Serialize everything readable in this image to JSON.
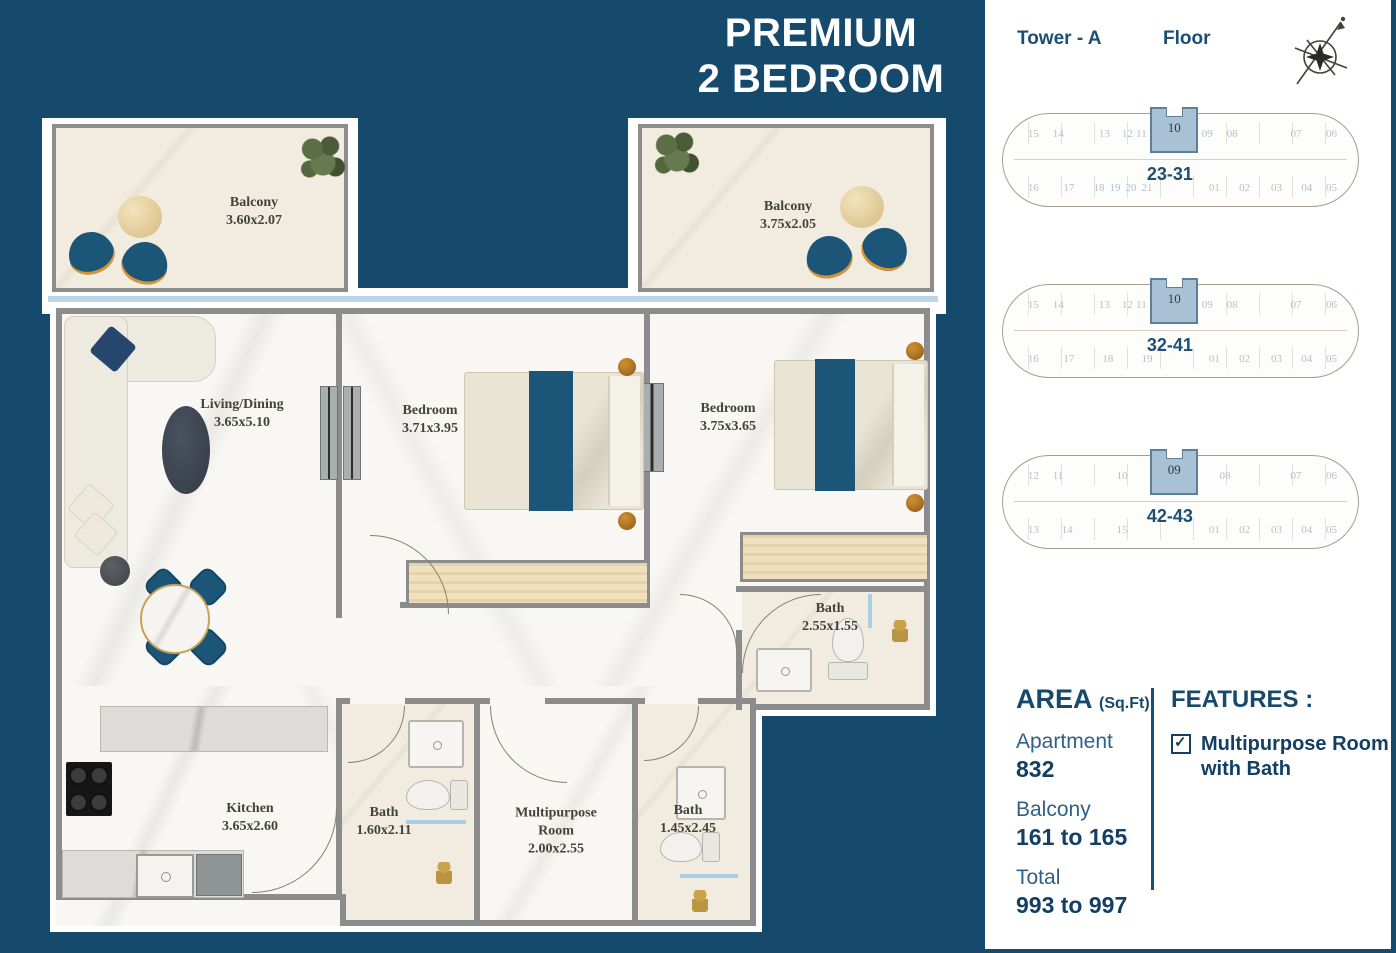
{
  "colors": {
    "brand_blue": "#164a6d",
    "accent_text": "#1d4e74",
    "highlight_unit_fill": "#a9c1d4",
    "furniture_teal": "#1b5578",
    "window_glass": "#b9d7ea",
    "wall_gray": "#8c8c8c"
  },
  "title": {
    "line1": "PREMIUM",
    "line2": "2 BEDROOM"
  },
  "header": {
    "tower": "Tower - A",
    "floor": "Floor",
    "compass_icon": "compass-rose-icon"
  },
  "plates": [
    {
      "range": "23-31",
      "unit": "10",
      "top": [
        "15",
        "14",
        "13",
        "12",
        "11",
        "09",
        "08",
        "07",
        "06"
      ],
      "bottom": [
        "16",
        "17",
        "18",
        "19",
        "20",
        "21",
        "01",
        "02",
        "03",
        "04",
        "05"
      ]
    },
    {
      "range": "32-41",
      "unit": "10",
      "top": [
        "15",
        "14",
        "13",
        "12",
        "11",
        "09",
        "08",
        "07",
        "06"
      ],
      "bottom": [
        "16",
        "17",
        "18",
        "19",
        "01",
        "02",
        "03",
        "04",
        "05"
      ]
    },
    {
      "range": "42-43",
      "unit": "09",
      "top": [
        "12",
        "11",
        "10",
        "08",
        "07",
        "06"
      ],
      "bottom": [
        "13",
        "14",
        "15",
        "01",
        "02",
        "03",
        "04",
        "05"
      ]
    }
  ],
  "rooms": [
    {
      "name": "Balcony",
      "dims": "3.60x2.07"
    },
    {
      "name": "Balcony",
      "dims": "3.75x2.05"
    },
    {
      "name": "Living/Dining",
      "dims": "3.65x5.10"
    },
    {
      "name": "Bedroom",
      "dims": "3.71x3.95"
    },
    {
      "name": "Bedroom",
      "dims": "3.75x3.65"
    },
    {
      "name": "Bath",
      "dims": "2.55x1.55"
    },
    {
      "name": "Kitchen",
      "dims": "3.65x2.60"
    },
    {
      "name": "Bath",
      "dims": "1.60x2.11"
    },
    {
      "name": "Multipurpose Room",
      "dims": "2.00x2.55"
    },
    {
      "name": "Bath",
      "dims": "1.45x2.45"
    }
  ],
  "area": {
    "heading": "AREA",
    "unit": "(Sq.Ft)",
    "items": [
      {
        "label": "Apartment",
        "value": "832"
      },
      {
        "label": "Balcony",
        "value": "161 to 165"
      },
      {
        "label": "Total",
        "value": "993 to 997"
      }
    ]
  },
  "features": {
    "heading": "FEATURES :",
    "items": [
      {
        "label": "Multipurpose Room with Bath",
        "checked": true,
        "icon": "checkbox-checked-icon"
      }
    ]
  }
}
